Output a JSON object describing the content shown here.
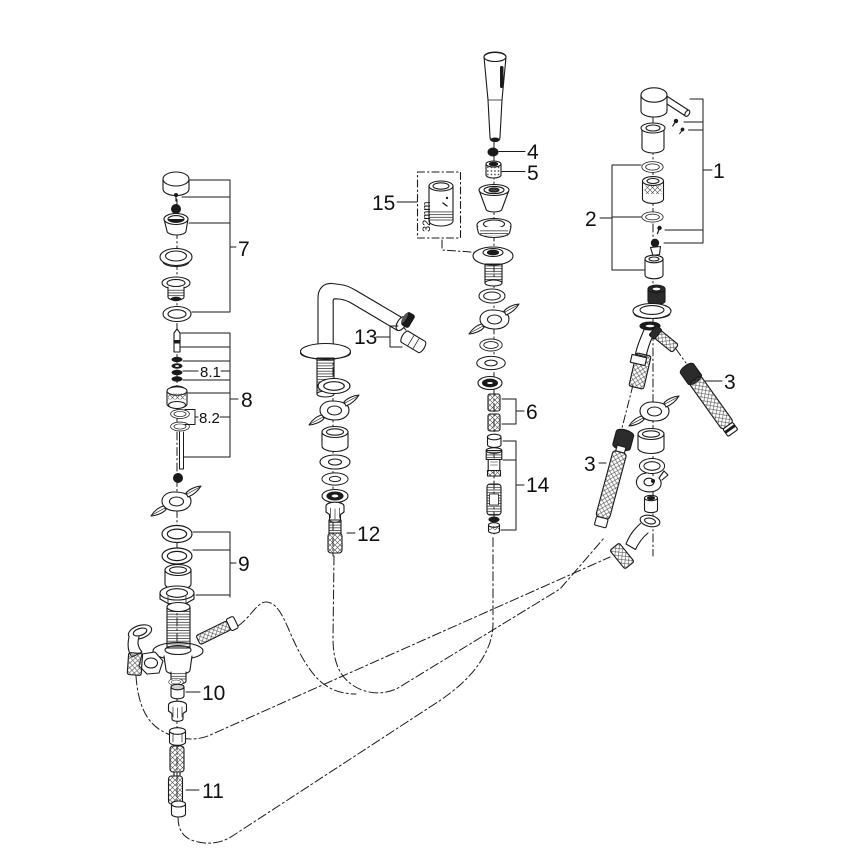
{
  "diagram": {
    "kind": "exploded-parts-diagram",
    "background": "#ffffff",
    "line_color": "#1a1a1a",
    "dimension_label": "32mm",
    "callouts": [
      {
        "text": "1"
      },
      {
        "text": "2"
      },
      {
        "text": "3"
      },
      {
        "text": "3"
      },
      {
        "text": "4"
      },
      {
        "text": "5"
      },
      {
        "text": "6"
      },
      {
        "text": "7"
      },
      {
        "text": "8"
      },
      {
        "text": "8.1"
      },
      {
        "text": "8.2"
      },
      {
        "text": "9"
      },
      {
        "text": "10"
      },
      {
        "text": "11"
      },
      {
        "text": "12"
      },
      {
        "text": "13"
      },
      {
        "text": "14"
      },
      {
        "text": "15"
      }
    ]
  }
}
